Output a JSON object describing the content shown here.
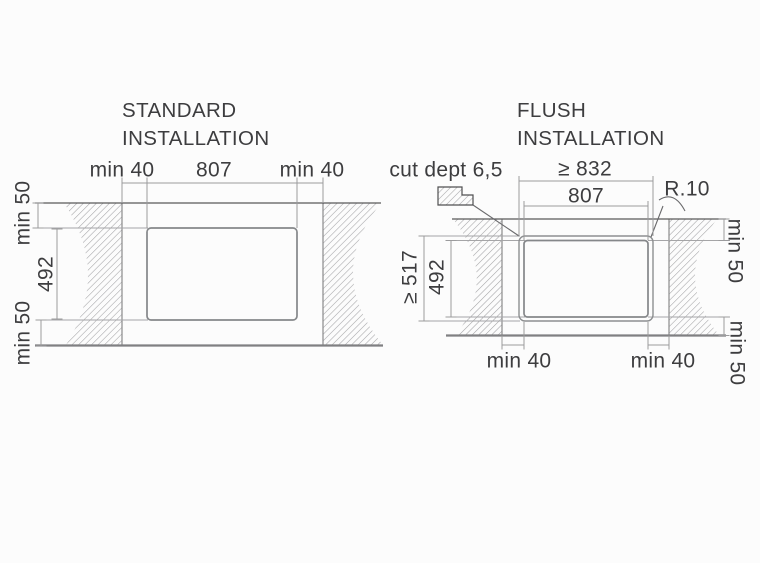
{
  "standard": {
    "title": [
      "STANDARD",
      "INSTALLATION"
    ],
    "top_dims": {
      "left": "min 40",
      "center": "807",
      "right": "min 40"
    },
    "left_dims": {
      "top": "min 50",
      "middle": "492",
      "bottom": "min 50"
    }
  },
  "flush": {
    "title": [
      "FLUSH",
      "INSTALLATION"
    ],
    "cut_depth": "cut dept 6,5",
    "top_dims": {
      "outer": "≥ 832",
      "inner": "807"
    },
    "corner_radius": "R.10",
    "left_dims": {
      "outer": "≥ 517",
      "inner": "492"
    },
    "right_dims": {
      "top": "min 50",
      "bottom": "min 50"
    },
    "bottom_dims": {
      "left": "min 40",
      "right": "min 40"
    }
  },
  "colors": {
    "text": "#3d3d3f",
    "line_dark": "#58585a",
    "line_mid": "#8a8a8c",
    "line_light": "#a5a5a7",
    "hatch": "#a3a3a5",
    "background": "#fcfcfc"
  }
}
